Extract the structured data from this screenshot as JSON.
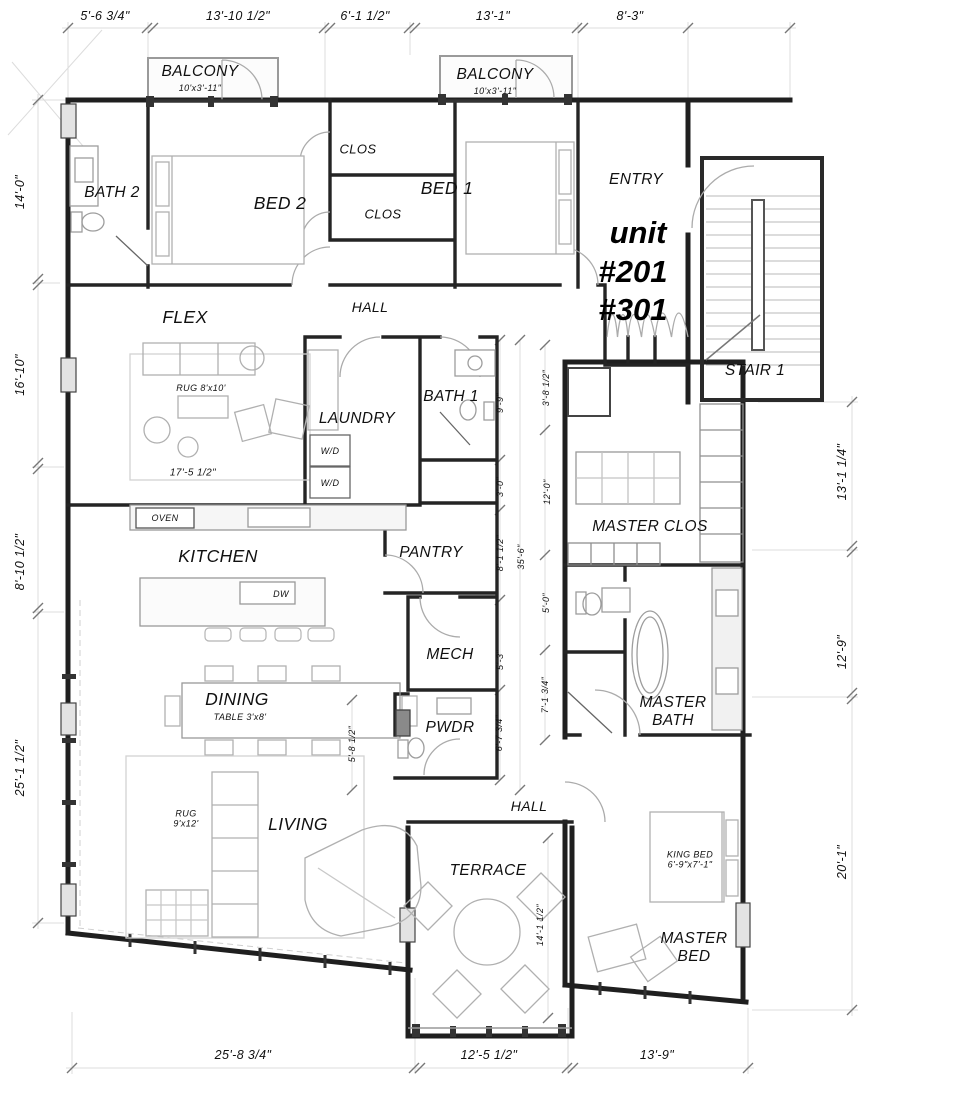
{
  "unit": {
    "label": "unit",
    "num1": "#201",
    "num2": "#301"
  },
  "rooms": {
    "balcony_left": {
      "name": "BALCONY",
      "size": "10'x3'-11\""
    },
    "balcony_right": {
      "name": "BALCONY",
      "size": "10'x3'-11\""
    },
    "bath2": "BATH 2",
    "bed2": "BED 2",
    "clos_a": "CLOS",
    "clos_b": "CLOS",
    "bed1": "BED 1",
    "entry": "ENTRY",
    "stair": "STAIR 1",
    "hall_a": "HALL",
    "flex": "FLEX",
    "laundry": "LAUNDRY",
    "bath1": "BATH 1",
    "master_clos": "MASTER CLOS",
    "kitchen": "KITCHEN",
    "pantry": "PANTRY",
    "mech": "MECH",
    "dining": "DINING",
    "pwdr": "PWDR",
    "master_bath": "MASTER BATH",
    "living": "LIVING",
    "hall_b": "HALL",
    "terrace": "TERRACE",
    "master_bed": "MASTER BED"
  },
  "annotations": {
    "rug_flex": "RUG 8'x10'",
    "flex_w": "17'-5 1/2\"",
    "wd1": "W/D",
    "wd2": "W/D",
    "oven": "OVEN",
    "dw": "DW",
    "table_dining": "TABLE 3'x8'",
    "rug_living": "RUG 9'x12'",
    "king_bed": "KING BED 6'-9\"x7'-1\""
  },
  "dimensions": {
    "top": [
      "5'-6 3/4\"",
      "13'-10 1/2\"",
      "6'-1 1/2\"",
      "13'-1\"",
      "8'-3\""
    ],
    "left": [
      "14'-0\"",
      "16'-10\"",
      "8'-10 1/2\"",
      "25'-1 1/2\""
    ],
    "right": [
      "13'-1 1/4\"",
      "12'-9\"",
      "20'-1\""
    ],
    "bottom": [
      "25'-8 3/4\"",
      "12'-5 1/2\"",
      "13'-9\""
    ],
    "interior": [
      "9'-9\"",
      "3'-0\"",
      "8'-1 1/2\"",
      "5'-3\"",
      "6'-7 3/4\"",
      "35'-6\"",
      "3'-8 1/2\"",
      "12'-0\"",
      "5'-0\"",
      "7'-1 3/4\"",
      "5'-8 1/2\"",
      "14'-1 1/2\""
    ]
  }
}
